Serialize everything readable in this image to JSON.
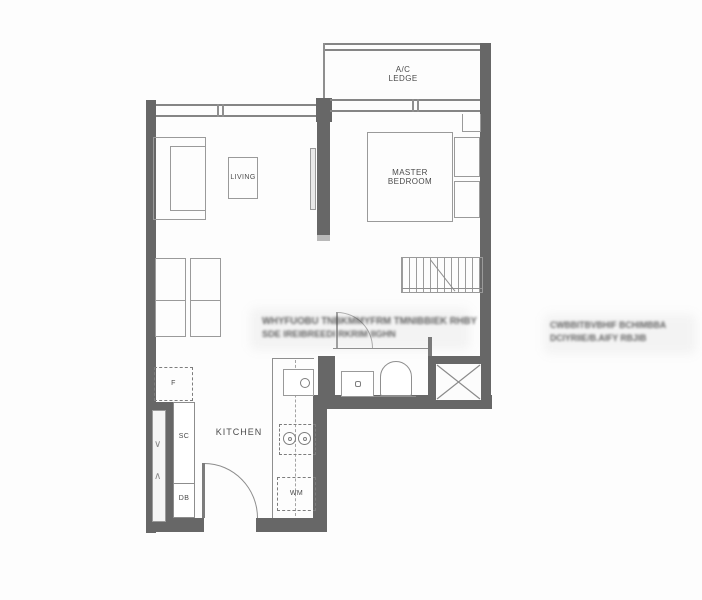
{
  "colors": {
    "wall": "#676767",
    "line": "#8f8f8f",
    "furn": "#9a9a9a",
    "text": "#4b4b4b",
    "cap": "#b9b9b9"
  },
  "labels": {
    "ac_line1": "A/C",
    "ac_line2": "LEDGE",
    "living": "LIVING",
    "master_line1": "MASTER",
    "master_line2": "BEDROOM",
    "kitchen": "KITCHEN",
    "fridge": "F",
    "service_cabinet": "SC",
    "db_box": "DB",
    "washing_machine": "WM"
  },
  "symbols": {
    "duct_up": "∨",
    "duct_down": "∧"
  },
  "watermarks": {
    "center": {
      "line1": "WHYFUOBU TNBKMMYFRM TMNIBBIEK RHBY",
      "line2": "SDE IREIBREEDI    RKRIM IIGHN"
    },
    "right": {
      "line1": "CWBBITBVBHIF BCHIMBBA",
      "line2": "DCIYRIIE/B.AIFY RBJIB"
    }
  }
}
